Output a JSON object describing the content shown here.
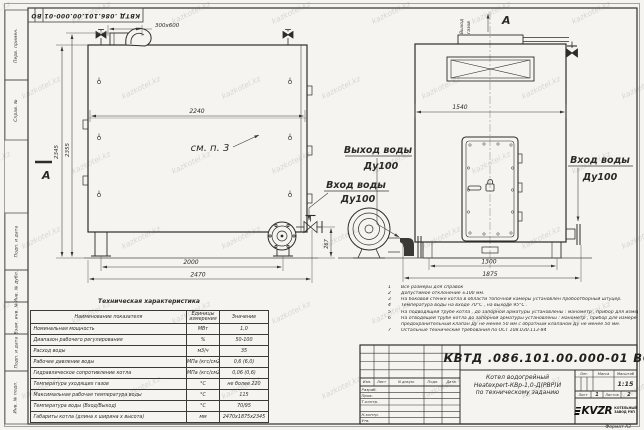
{
  "page": {
    "watermark": "kazkotel.kz",
    "format_label": "Формат  А3"
  },
  "top_stamp": {
    "doc_number": "КВТД .086.101.00.000-01  ВО"
  },
  "margin_fields": {
    "perv": "Перв. примен.",
    "sprav": "Справ. №",
    "podp1": "Подп. и дата",
    "inv_dubl": "Инв. № дубл.",
    "vzam": "Взам. инв. №",
    "podp2": "Подп. и дата",
    "inv_podl": "Инв. № подл."
  },
  "drawing": {
    "left_view": {
      "dim_flue": "300х600",
      "dim_width_mid": "2240",
      "dim_height1": "2345",
      "dim_height2": "2355",
      "dim_base": "2000",
      "dim_overall": "2470",
      "dim_inlet_h": "267",
      "ref_note": "см. п. 3",
      "section_label": "А"
    },
    "right_view": {
      "gas_out_line1": "Выход",
      "gas_out_line2": "газов",
      "view_label": "А",
      "dim_width_mid": "1540",
      "dim_base": "1300",
      "dim_overall": "1875"
    },
    "labels": {
      "water_out_name": "Выход воды",
      "water_out_dn": "Ду100",
      "water_in_left_name": "Вход воды",
      "water_in_left_dn": "Ду100",
      "water_in_right_name": "Вход воды",
      "water_in_right_dn": "Ду100"
    }
  },
  "notes": {
    "lines": [
      {
        "num": "1",
        "text": "Все размеры для справок"
      },
      {
        "num": "2",
        "text": "Допустимое отклонение  ±100 мм."
      },
      {
        "num": "3",
        "text": "На боковой стенке котла в области топочной камеры установлен пробоотборный штуцер."
      },
      {
        "num": "4",
        "text": "Температура воды на входе  70°С , на выходе  95°С ."
      },
      {
        "num": "5",
        "text": "На  подводящей трубе котла , до запорной арматуры установлены : манометр , прибор для измерения температуры."
      },
      {
        "num": "6",
        "text": "На отводящей трубе котла до запорной арматуры установлены : манометр , прибор для измерения температуры ,"
      },
      {
        "num": "",
        "text": "предохранительный клапан  Ду не менее 50 мм с обратным клапаном  Ду не менее 50 мм."
      },
      {
        "num": "7",
        "text": "Остальные технические требования по ОСТ  108.030.113-84"
      }
    ]
  },
  "tech_table": {
    "title": "Техническая характеристика",
    "col_name": "Наименование показателя",
    "col_unit": "Единицы измерения",
    "col_value": "Значение",
    "rows": [
      {
        "name": "Номинальная мощность",
        "unit": "МВт",
        "value": "1,0"
      },
      {
        "name": "Диапазон рабочего регулирования",
        "unit": "%",
        "value": "50-100"
      },
      {
        "name": "Расход воды",
        "unit": "м3/ч",
        "value": "35"
      },
      {
        "name": "Рабочее давление воды",
        "unit": "МПа (кгс/см2)",
        "value": "0,6 (6,0)"
      },
      {
        "name": "Гидравлическое сопротивление котла",
        "unit": "МПа (кгс/см2)",
        "value": "0,06 (0,6)"
      },
      {
        "name": "Температура уходящих газов",
        "unit": "°С",
        "value": "не более 220"
      },
      {
        "name": "Максимальная рабочая температура воды",
        "unit": "°С",
        "value": "115"
      },
      {
        "name": "Температура воды (Вход/Выход)",
        "unit": "°С",
        "value": "70/95"
      },
      {
        "name": "Габариты котла (длина х ширина х высота)",
        "unit": "мм",
        "value": "2470х1875х2345"
      }
    ]
  },
  "title_block": {
    "doc_number": "КВТД .086.101.00.000-01  ВО",
    "product_line1": "Котел водогрейный",
    "product_line2": "Heatexpert-КВр-1,0-Д(РВР)И",
    "product_line3": "по техническому заданию",
    "col_izm": "Изм.",
    "col_list": "Лист",
    "col_ndoc": "N докум.",
    "col_podp": "Подп.",
    "col_data": "Дата",
    "row_razrab": "Разраб.",
    "row_prov": "Пров.",
    "row_tkontr": "Т.контр.",
    "row_nkontr": "Н.контр.",
    "row_utv": "Утв.",
    "lit_label": "Лит.",
    "mass_label": "Масса",
    "scale_label": "Масштаб",
    "scale_value": "1:15",
    "sheet_label": "Лист",
    "sheet_value": "1",
    "sheets_label": "Листов",
    "sheets_value": "2",
    "logo_text": "KVZR",
    "company_line1": "КОТЕЛЬНЫЙ",
    "company_line2": "ЗАВОД РЭП"
  }
}
